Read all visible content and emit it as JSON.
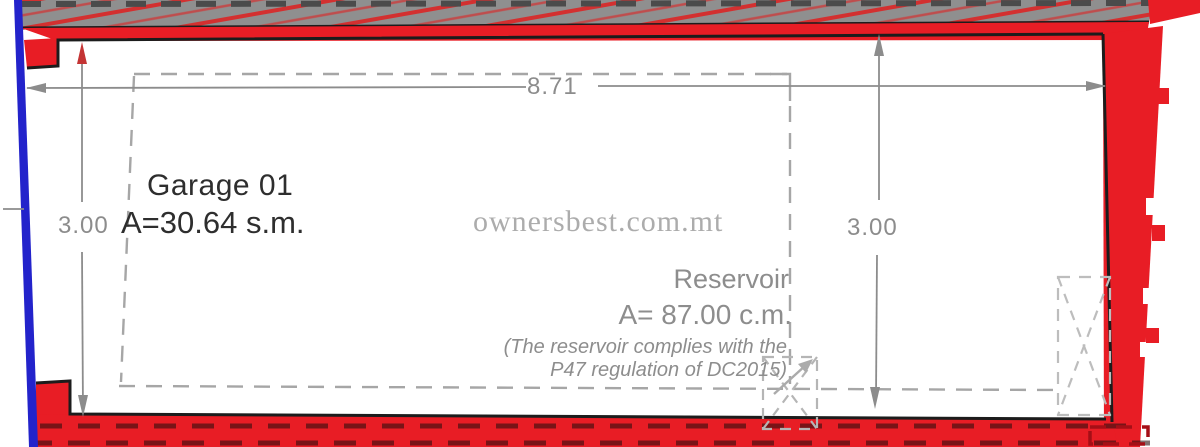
{
  "plan": {
    "garage": {
      "title": "Garage 01",
      "area": "A=30.64 s.m."
    },
    "reservoir": {
      "title": "Reservoir",
      "area": "A= 87.00 c.m.",
      "note_line1": "(The reservoir complies with the",
      "note_line2": "P47 regulation of DC2015)"
    },
    "dimensions": {
      "width_top": "8.71",
      "height_left": "3.00",
      "height_right": "3.00"
    },
    "watermark": "ownersbest.com.mt",
    "colors": {
      "wall_red": "#e81d25",
      "band_gray": "#8f8f8f",
      "hatch_red": "#d33030",
      "party_blue": "#2323cb",
      "dim_gray": "#8c8c8c",
      "text_dark": "#2e2e2e",
      "note_gray": "#8d8d8d",
      "watermark_gray": "#9e9e9e",
      "outline_black": "#1c1c1c",
      "marker_red": "#a50f16",
      "dash_gray": "#a6a6a6"
    }
  }
}
